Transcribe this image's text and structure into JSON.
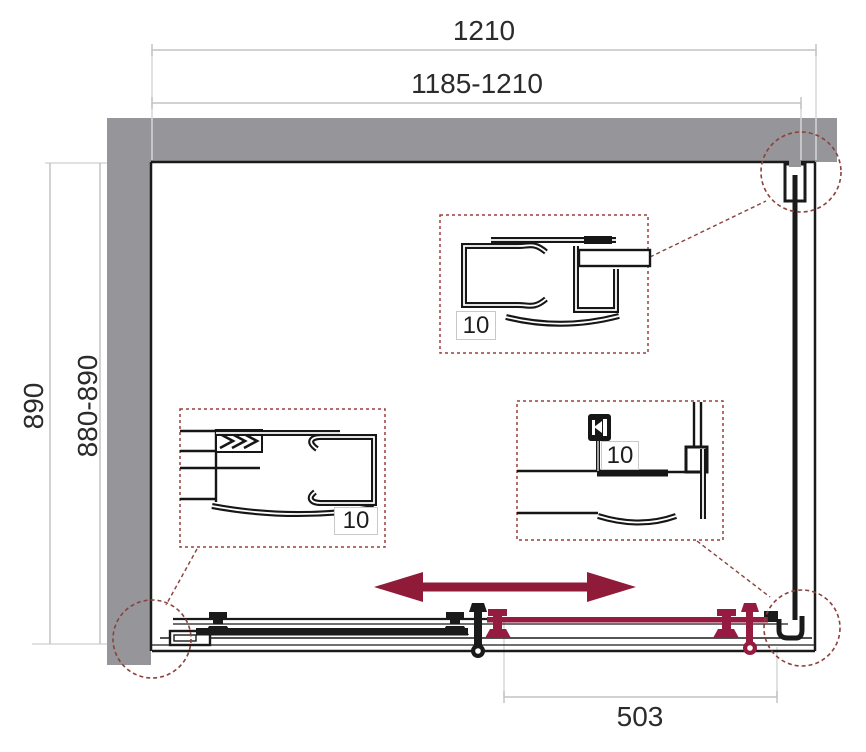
{
  "dimensions": {
    "top_overall": "1210",
    "top_adjustable": "1185-1210",
    "side_overall": "890",
    "side_adjustable": "880-890",
    "door_section": "503"
  },
  "details": {
    "top_wall_profile": {
      "label": "10"
    },
    "left_wall_profile": {
      "label": "10"
    },
    "corner_profile": {
      "label": "10"
    }
  },
  "colors": {
    "wall_gray": "#96969a",
    "line_black": "#1a1a1a",
    "accent_red": "#951c40",
    "arrow_red": "#8f1b38",
    "dashed_callout": "#8a423c",
    "dimension_gray": "#c4c4c4"
  }
}
